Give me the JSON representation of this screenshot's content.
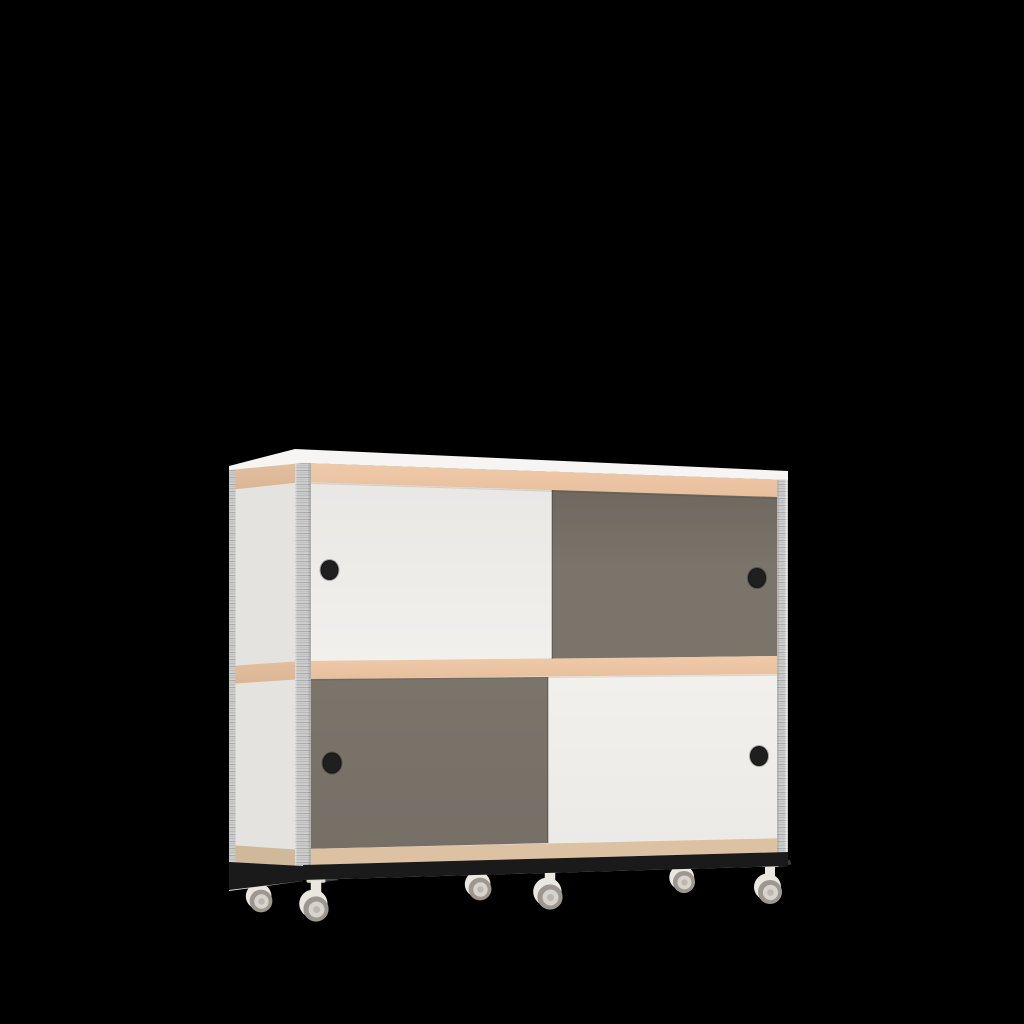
{
  "scene": {
    "type": "3d-product-render",
    "object": "Two-tier mobile sideboard cabinet with four sliding doors (checkerboard white/grey), plywood edge bands, black plinth and six swivel casters",
    "doors": [
      {
        "id": "top-left",
        "color_name": "white"
      },
      {
        "id": "top-right",
        "color_name": "grey"
      },
      {
        "id": "bottom-left",
        "color_name": "grey"
      },
      {
        "id": "bottom-right",
        "color_name": "white"
      }
    ],
    "handle_count": 4,
    "caster_count": 6
  },
  "colors": {
    "background": "#000000",
    "door_white": "#f1f0ed",
    "door_grey": "#7b746b",
    "door_grey_deep": "#6f6860",
    "band_tan": "#e7bf9d",
    "band_tan_light": "#efcaa9",
    "band_tan_bottom": "#dcc2a3",
    "top_white": "#f6f5f3",
    "ply_grey": "#cfcfcf",
    "ply_stripe": "#a8a8a8",
    "ply_stripe2": "#bdbdbd",
    "plinth": "#1a1a1a",
    "handle": "#1f1f1f",
    "caster_body": "#eae7e1",
    "caster_plate": "#dcd9d3",
    "caster_wheel": "#9d978f",
    "caster_hub": "#d7d4ce",
    "caster_cap": "#bcb8b1",
    "caster_brake": "#3a3a3a"
  }
}
